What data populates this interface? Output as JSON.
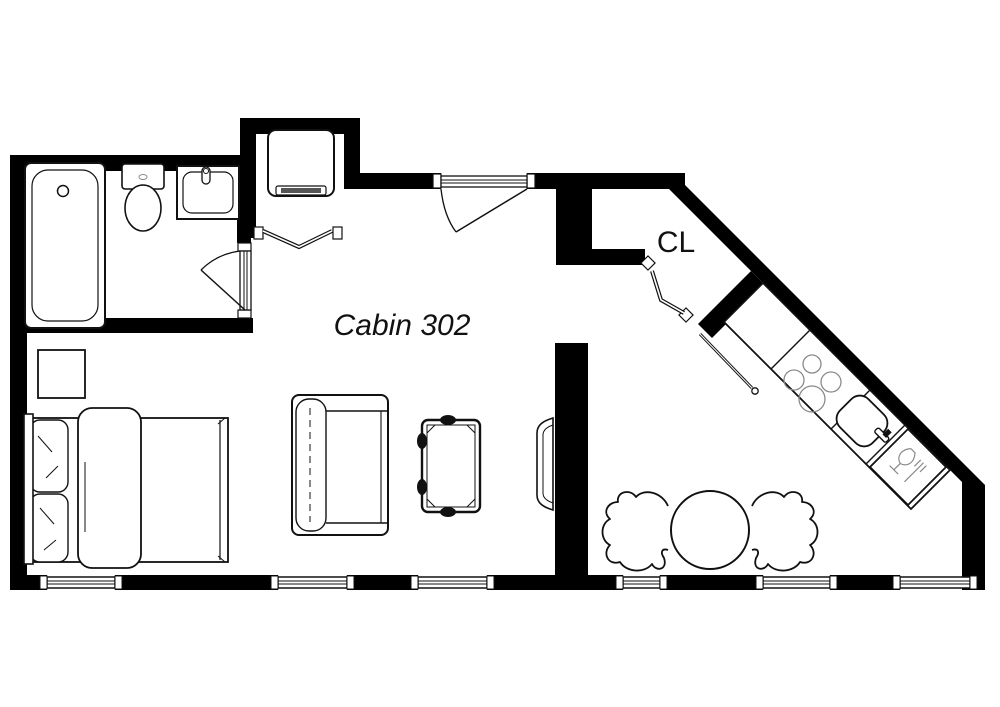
{
  "title": "Cabin 302 floor plan",
  "labels": {
    "cabin": "Cabin 302",
    "closet": "CL"
  },
  "colors": {
    "wall": "#000000",
    "background": "#ffffff",
    "line": "#111111",
    "fixture_detail": "#8a8a8a"
  },
  "rooms": [
    {
      "name": "bathroom"
    },
    {
      "name": "main-cabin",
      "label": "Cabin 302"
    },
    {
      "name": "closet",
      "label": "CL"
    },
    {
      "name": "kitchenette"
    }
  ],
  "fixtures": [
    "bathtub",
    "toilet",
    "bathroom-sink",
    "washer",
    "bed",
    "pillows",
    "nightstand",
    "sofa",
    "coffee-table",
    "tv",
    "dining-table",
    "dining-chairs",
    "cooktop",
    "kitchen-sink",
    "dishwasher",
    "entry-door",
    "bathroom-door",
    "bifold-doors",
    "windows"
  ]
}
